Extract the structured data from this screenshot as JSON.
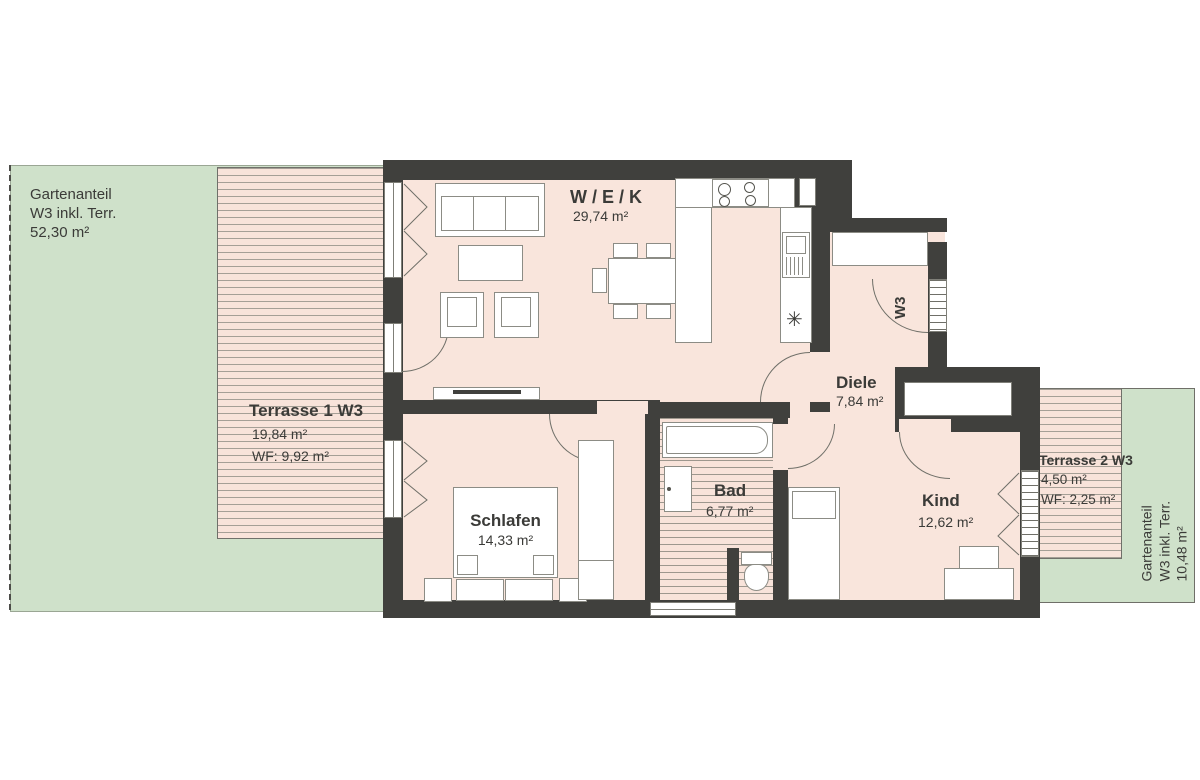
{
  "plan_title": "Wohnung W3 Grundriss",
  "colors": {
    "wall": "#40403d",
    "floor": "#f9e5dc",
    "deck": "#f8e3da",
    "garden": "#cfe1ca",
    "line": "#6f6f68",
    "text": "#3b3b38"
  },
  "garden_left": {
    "line1": "Gartenanteil",
    "line2": "W3 inkl. Terr.",
    "line3": "52,30 m²"
  },
  "garden_right": {
    "line1": "Gartenanteil",
    "line2": "W3 inkl. Terr.",
    "line3": "10,48 m²"
  },
  "terrace1": {
    "name": "Terrasse 1 W3",
    "area": "19,84 m²",
    "wf": "WF: 9,92 m²"
  },
  "terrace2": {
    "name": "Terrasse 2 W3",
    "area": "4,50 m²",
    "wf": "WF: 2,25 m²"
  },
  "rooms": {
    "wek": {
      "name": "W / E / K",
      "area": "29,74 m²"
    },
    "diele": {
      "name": "Diele",
      "area": "7,84 m²"
    },
    "schlafen": {
      "name": "Schlafen",
      "area": "14,33 m²"
    },
    "bad": {
      "name": "Bad",
      "area": "6,77 m²"
    },
    "kind": {
      "name": "Kind",
      "area": "12,62 m²"
    }
  },
  "entrance": {
    "label": "W3"
  },
  "symbols": {
    "sink": "✳"
  }
}
